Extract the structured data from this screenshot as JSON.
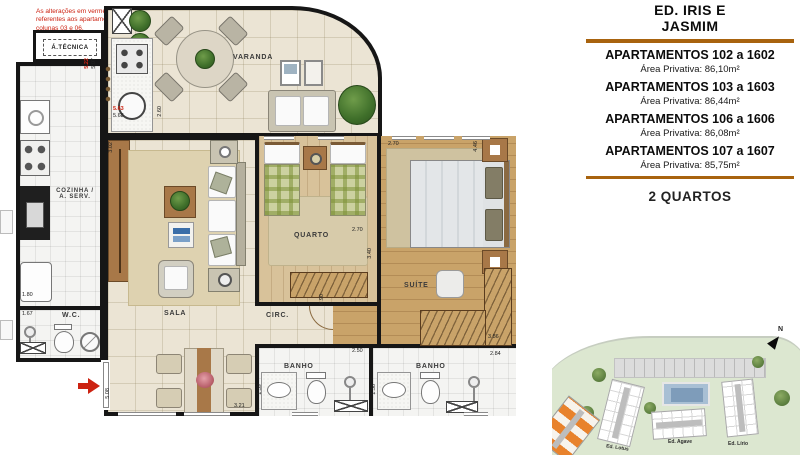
{
  "colors": {
    "accent": "#a8630e",
    "alteration": "#cc2211",
    "wall": "#161616",
    "orange_building": "#e8822c"
  },
  "note": "As alterações em vermelho são referentes aos apartamentos das colunas 03 e 06.",
  "signature": "Rodrigo Decoto",
  "plan": {
    "rooms": {
      "atecnica": "Á.TÉCNICA",
      "varanda": "VARANDA",
      "cozinha1": "COZINHA /",
      "cozinha2": "A. SERV.",
      "wc": "W.C.",
      "sala": "SALA",
      "circ": "CIRC.",
      "quarto": "QUARTO",
      "suite": "SUÍTE",
      "banho": "BANHO"
    },
    "dims": [
      "5.22",
      "5.07",
      "5.63",
      "5.68",
      "2.60",
      "3.02",
      "1.80",
      "1.67",
      "5.08",
      "3.21",
      "2.70",
      "3.40",
      "2.70",
      "4.46",
      "3.86",
      "2.84",
      "2.50",
      "1.39",
      "1.38",
      "0.90"
    ]
  },
  "panel": {
    "title_line1": "ED. IRIS E",
    "title_line2": "JASMIM",
    "apartments": [
      {
        "name": "APARTAMENTOS 102 a 1602",
        "area": "Área Privativa: 86,10m²"
      },
      {
        "name": "APARTAMENTOS 103 a 1603",
        "area": "Área Privativa: 86,44m²"
      },
      {
        "name": "APARTAMENTOS 106 a 1606",
        "area": "Área Privativa: 86,08m²"
      },
      {
        "name": "APARTAMENTOS 107 a 1607",
        "area": "Área Privativa: 85,75m²"
      }
    ],
    "footer": "2 QUARTOS"
  },
  "siteplan": {
    "compass": "N",
    "buildings": [
      {
        "label": "Ed. Lotus"
      },
      {
        "label": "Ed. Agave"
      },
      {
        "label": "Ed. Lírio"
      }
    ]
  }
}
